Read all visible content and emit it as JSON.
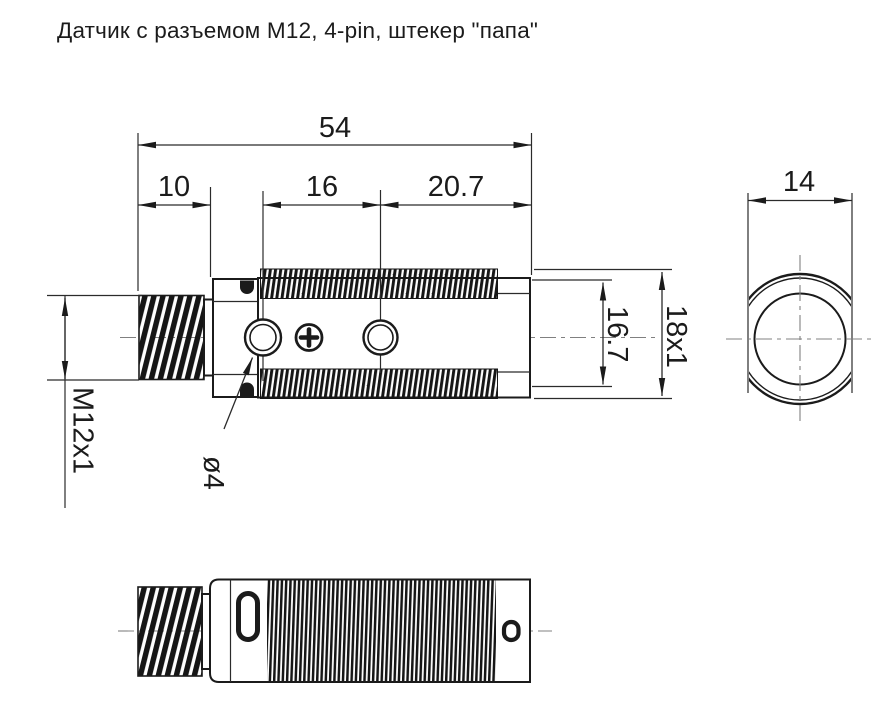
{
  "title": "Датчик с разъемом M12, 4-pin, штекер \"папа\"",
  "line_color": "#1b1b1b",
  "dimensions": {
    "total_length": "54",
    "connector_length": "10",
    "hole_spacing": "16",
    "rear_length": "20.7",
    "connector_thread": "M12x1",
    "hole_diameter": "ø4",
    "body_diameter": "16.7",
    "body_thread": "18x1",
    "across_flats": "14"
  }
}
